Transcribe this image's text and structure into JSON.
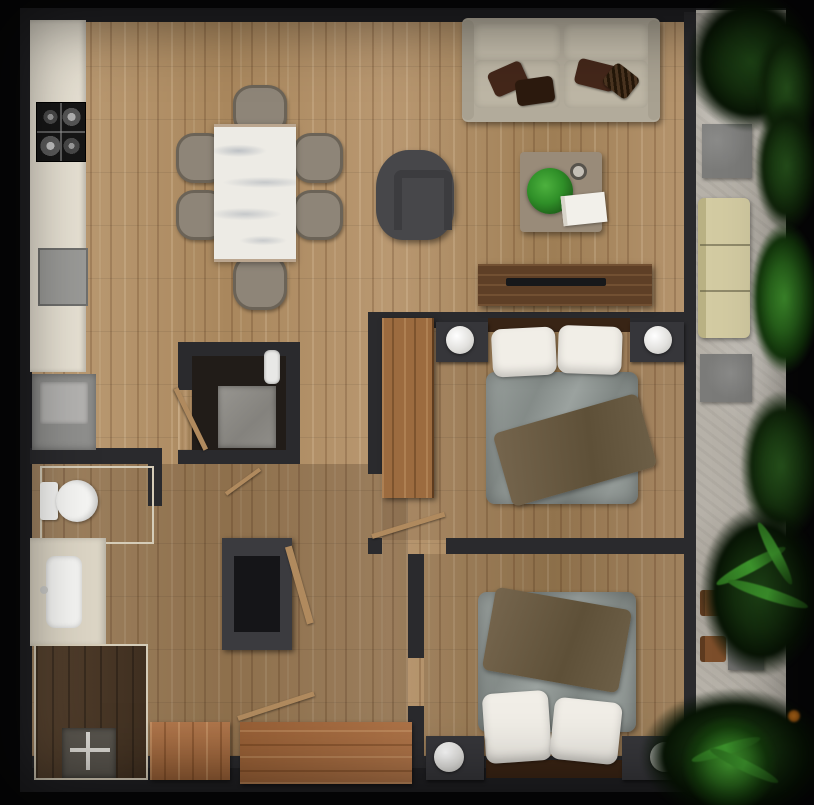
{
  "scene": {
    "type": "top-down 3d apartment floor plan render",
    "rooms": [
      {
        "name": "kitchen",
        "items": [
          "counter",
          "gas-cooktop",
          "kitchen-sink",
          "washing-machine"
        ]
      },
      {
        "name": "dining-area",
        "items": [
          "marble-dining-table",
          "dining-chair",
          "dining-chair",
          "dining-chair",
          "dining-chair",
          "dining-chair",
          "dining-chair"
        ]
      },
      {
        "name": "living-room",
        "items": [
          "two-seat-sofa",
          "brown-accent-pillows",
          "armchair",
          "coffee-table",
          "potted-plant",
          "book",
          "cup",
          "tv-console",
          "tv"
        ]
      },
      {
        "name": "bedroom-1",
        "items": [
          "double-bed",
          "white-pillows",
          "gray-duvet",
          "olive-throw",
          "nightstand",
          "nightstand",
          "ball-lamp",
          "ball-lamp",
          "wood-wardrobe"
        ]
      },
      {
        "name": "bedroom-2",
        "items": [
          "double-bed",
          "white-pillows",
          "gray-duvet",
          "olive-throw",
          "nightstand",
          "nightstand",
          "ball-lamp",
          "ball-lamp"
        ]
      },
      {
        "name": "bathroom",
        "items": [
          "toilet",
          "vanity",
          "vanity-sink",
          "walk-in-shower",
          "shower-fixture",
          "glass-partition"
        ]
      },
      {
        "name": "utility-closet",
        "items": [
          "appliance",
          "wall-panel",
          "door-leaf"
        ]
      },
      {
        "name": "hallway",
        "items": [
          "storage-cabinet",
          "leaning-door",
          "wood-sideboard",
          "wood-sideboard",
          "door-leaf",
          "door-leaf"
        ]
      },
      {
        "name": "balcony",
        "items": [
          "stone-paver",
          "stone-paver",
          "outdoor-sofa",
          "outdoor-chair",
          "outdoor-chair",
          "outdoor-side-table",
          "outdoor-side-table",
          "railing",
          "plants",
          "palm-plants"
        ]
      }
    ]
  },
  "palette": {
    "bg": "#070708",
    "wall": "#2a2a2d",
    "wallDark": "#202023",
    "wood": "#b3926b",
    "woodDark": "#4c3a29",
    "counter": "#e7e1d3",
    "marble": "#edebe5",
    "chair": "#8e8578",
    "chairRim": "#6b6357",
    "sofa": "#b2ab9b",
    "sofaCushion": "#c3bcab",
    "pillowBrown": "#44271a",
    "pillowBrownDark": "#2c1a0e",
    "armchair": "#47474a",
    "coffeeTable": "#998b79",
    "plantGreen": "#2f8f28",
    "tvConsole": "#5e3f26",
    "tvScreen": "#17181a",
    "wardrobe": "#9c6b3f",
    "cabinetWood": "#a86a3c",
    "nightstand": "#36363a",
    "lamp": "#f4f3f0",
    "headboard": "#382415",
    "pillowWhite": "#f1eee7",
    "duvet": "#8d918e",
    "throw": "#6b5b45",
    "fixture": "#3b3b3f",
    "fixtureInner": "#151518",
    "white": "#f5f5f3",
    "vanity": "#dcd5c5",
    "appliance": "#9a9a97",
    "concrete": "#b6b1a8",
    "paver": "#7b7b79",
    "outdoorSofa": "#d3cba2",
    "outdoorChair": "#7c4e2b",
    "outdoorTable": "#6e6e6c",
    "door": "#b08a5e",
    "glass": "#d5ccb8",
    "railing": "#d8d3c8"
  }
}
